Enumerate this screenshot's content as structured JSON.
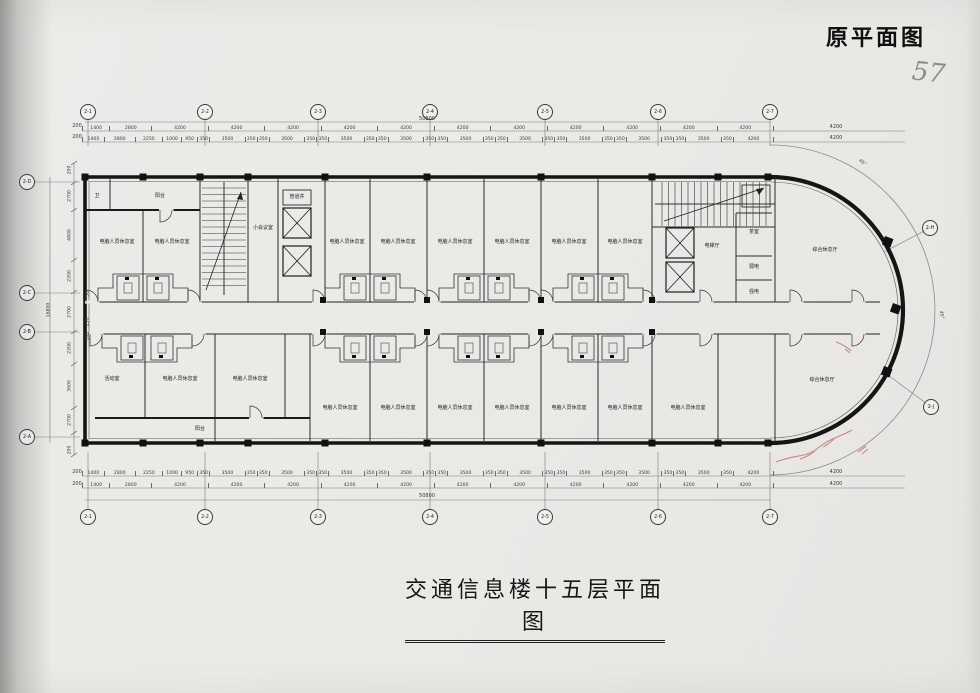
{
  "page": {
    "corner_label": "原平面图",
    "handwritten_mark": "57",
    "title": "交通信息楼十五层平面图"
  },
  "plan": {
    "axis_bubbles": {
      "top": [
        {
          "label": "2-1",
          "x": 88
        },
        {
          "label": "2-2",
          "x": 205
        },
        {
          "label": "2-3",
          "x": 318
        },
        {
          "label": "2-4",
          "x": 430
        },
        {
          "label": "2-5",
          "x": 545
        },
        {
          "label": "2-6",
          "x": 658
        },
        {
          "label": "2-7",
          "x": 770
        }
      ],
      "bottom": [
        {
          "label": "2-1",
          "x": 88
        },
        {
          "label": "2-2",
          "x": 205
        },
        {
          "label": "2-3",
          "x": 318
        },
        {
          "label": "2-4",
          "x": 430
        },
        {
          "label": "2-5",
          "x": 545
        },
        {
          "label": "2-6",
          "x": 658
        },
        {
          "label": "2-7",
          "x": 770
        }
      ],
      "left": [
        {
          "label": "2-D",
          "y": 182
        },
        {
          "label": "2-C",
          "y": 293
        },
        {
          "label": "2-B",
          "y": 332
        },
        {
          "label": "2-A",
          "y": 437
        }
      ],
      "arc": [
        {
          "label": "2-H",
          "x": 930,
          "y": 228
        },
        {
          "label": "2-J",
          "x": 931,
          "y": 407
        }
      ]
    },
    "dimensions": {
      "overall_width": "50800",
      "overall_height": "16800",
      "bay_row": [
        "1400",
        "2800",
        "4200",
        "4200",
        "4200",
        "4200",
        "4200",
        "4200",
        "4200",
        "4200",
        "4200",
        "4200",
        "4200"
      ],
      "detail_row": [
        "1400",
        "2800",
        "2250",
        "1000",
        "950",
        "350",
        "3500",
        "350",
        "350",
        "3500",
        "350",
        "350",
        "3500",
        "350",
        "350",
        "3500",
        "350",
        "350",
        "3500",
        "350",
        "350",
        "3500",
        "350",
        "350",
        "3500",
        "350",
        "350",
        "3500",
        "350",
        "350",
        "3500",
        "350",
        "4200"
      ],
      "left_column": [
        {
          "text": "200",
          "x": 70,
          "y": 170
        },
        {
          "text": "2700",
          "x": 70,
          "y": 196
        },
        {
          "text": "4800",
          "x": 70,
          "y": 235
        },
        {
          "text": "2200",
          "x": 70,
          "y": 276
        },
        {
          "text": "2700",
          "x": 70,
          "y": 312
        },
        {
          "text": "2200",
          "x": 70,
          "y": 348
        },
        {
          "text": "3600",
          "x": 70,
          "y": 386
        },
        {
          "text": "2700",
          "x": 70,
          "y": 420
        },
        {
          "text": "200",
          "x": 70,
          "y": 450
        },
        {
          "text": "50",
          "x": 88,
          "y": 294
        },
        {
          "text": "250",
          "x": 88,
          "y": 322
        },
        {
          "text": "100",
          "x": 88,
          "y": 336
        }
      ],
      "extra_labels": [
        {
          "text": "50800",
          "x": 427,
          "y": 119
        },
        {
          "text": "50800",
          "x": 427,
          "y": 496
        },
        {
          "text": "16800",
          "x": 49,
          "y": 310,
          "rot": -90
        },
        {
          "text": "200",
          "x": 77,
          "y": 126
        },
        {
          "text": "200",
          "x": 77,
          "y": 137
        },
        {
          "text": "200",
          "x": 77,
          "y": 472
        },
        {
          "text": "200",
          "x": 77,
          "y": 484
        },
        {
          "text": "4200",
          "x": 836,
          "y": 127
        },
        {
          "text": "4200",
          "x": 836,
          "y": 138
        },
        {
          "text": "4200",
          "x": 836,
          "y": 472
        },
        {
          "text": "4200",
          "x": 836,
          "y": 484
        },
        {
          "text": "45°",
          "x": 862,
          "y": 163,
          "rot": 40
        },
        {
          "text": "45°",
          "x": 941,
          "y": 315,
          "rot": 80
        }
      ]
    },
    "rooms": [
      {
        "label": "卫",
        "x": 97,
        "y": 196
      },
      {
        "label": "阳台",
        "x": 160,
        "y": 196
      },
      {
        "label": "电脑人员休息室",
        "x": 117,
        "y": 242
      },
      {
        "label": "电脑人员休息室",
        "x": 172,
        "y": 242
      },
      {
        "label": "小会议室",
        "x": 263,
        "y": 228
      },
      {
        "label": "管道井",
        "x": 297,
        "y": 197
      },
      {
        "label": "电脑人员休息室",
        "x": 347,
        "y": 242
      },
      {
        "label": "电脑人员休息室",
        "x": 398,
        "y": 242
      },
      {
        "label": "电脑人员休息室",
        "x": 455,
        "y": 242
      },
      {
        "label": "电脑人员休息室",
        "x": 512,
        "y": 242
      },
      {
        "label": "电脑人员休息室",
        "x": 569,
        "y": 242
      },
      {
        "label": "电脑人员休息室",
        "x": 625,
        "y": 242
      },
      {
        "label": "电梯厅",
        "x": 712,
        "y": 246
      },
      {
        "label": "茶室",
        "x": 754,
        "y": 232
      },
      {
        "label": "弱电",
        "x": 754,
        "y": 267
      },
      {
        "label": "强电",
        "x": 754,
        "y": 292
      },
      {
        "label": "综合休息厅",
        "x": 825,
        "y": 250
      },
      {
        "label": "活动室",
        "x": 112,
        "y": 379
      },
      {
        "label": "电脑人员休息室",
        "x": 180,
        "y": 379
      },
      {
        "label": "电脑人员休息室",
        "x": 250,
        "y": 379
      },
      {
        "label": "电脑人员休息室",
        "x": 340,
        "y": 408
      },
      {
        "label": "电脑人员休息室",
        "x": 398,
        "y": 408
      },
      {
        "label": "电脑人员休息室",
        "x": 455,
        "y": 408
      },
      {
        "label": "电脑人员休息室",
        "x": 512,
        "y": 408
      },
      {
        "label": "电脑人员休息室",
        "x": 569,
        "y": 408
      },
      {
        "label": "电脑人员休息室",
        "x": 625,
        "y": 408
      },
      {
        "label": "电脑人员休息室",
        "x": 688,
        "y": 408
      },
      {
        "label": "综合休息厅",
        "x": 822,
        "y": 380
      },
      {
        "label": "阳台",
        "x": 200,
        "y": 429
      }
    ]
  }
}
